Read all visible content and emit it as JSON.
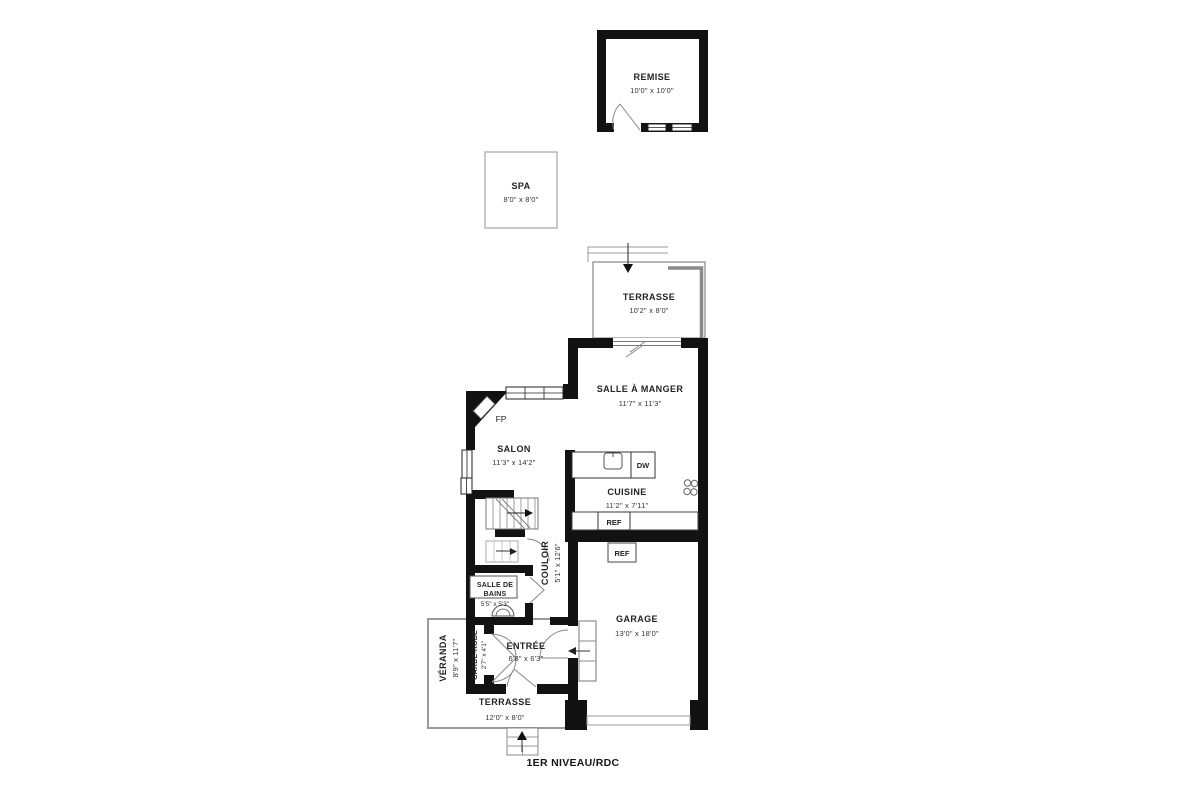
{
  "colors": {
    "wall": "#121212",
    "deck_line": "#9a9a9a",
    "thin_line": "#777777",
    "text": "#232323"
  },
  "floor_label": "1ER NIVEAU/RDC",
  "rooms": {
    "remise": {
      "name": "REMISE",
      "dims": "10'0\" x 10'0\""
    },
    "spa": {
      "name": "SPA",
      "dims": "8'0\" x 8'0\""
    },
    "terrasse_haut": {
      "name": "TERRASSE",
      "dims": "10'2\" x 8'0\""
    },
    "salle_a_manger": {
      "name": "SALLE À MANGER",
      "dims": "11'7\" x 11'3\""
    },
    "salon": {
      "name": "SALON",
      "dims": "11'3\" x 14'2\""
    },
    "cuisine": {
      "name": "CUISINE",
      "dims": "11'2\" x 7'11\""
    },
    "couloir": {
      "name": "COULOIR",
      "dims": "5'1\" x 12'6\""
    },
    "salle_de_bains": {
      "name_line1": "SALLE DE",
      "name_line2": "BAINS",
      "dims": "5'5\" x 5'3\""
    },
    "garage": {
      "name": "GARAGE",
      "dims": "13'0\" x 18'0\""
    },
    "garde_robe": {
      "name": "GARDE-ROBE",
      "dims": "2'7\" x 4'1\""
    },
    "entree": {
      "name": "ENTRÉE",
      "dims": "6'8\" x 6'3\""
    },
    "veranda": {
      "name": "VÉRANDA",
      "dims": "8'9\" x 11'7\""
    },
    "terrasse_bas": {
      "name": "TERRASSE",
      "dims": "12'0\" x 8'0\""
    }
  },
  "fixtures": {
    "fireplace": "FP",
    "dishwasher": "DW",
    "fridge_cuisine": "REF",
    "fridge_garage": "REF"
  }
}
